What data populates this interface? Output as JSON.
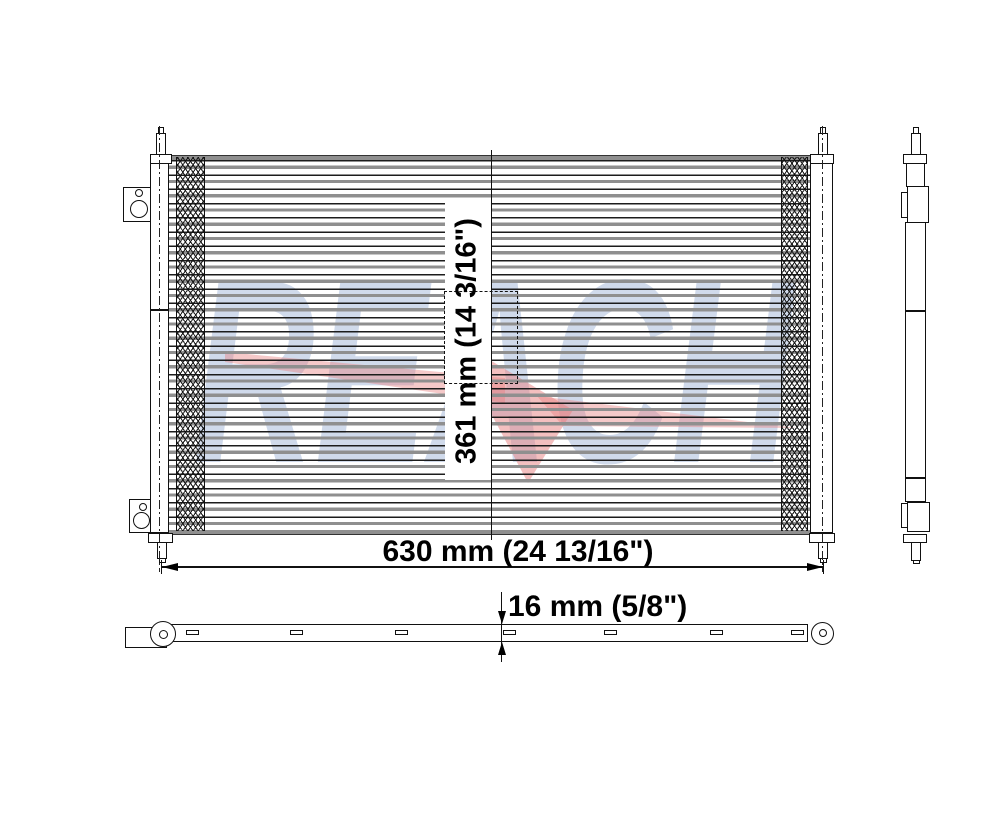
{
  "watermark": {
    "text": "REACH",
    "letter_color": "#ccd7e9",
    "swoosh_color": "#e87f7f"
  },
  "dimensions": {
    "width_label": "630 mm (24 13/16\")",
    "height_label": "361 mm (14 3/16\")",
    "depth_label": "16 mm (5/8\")"
  },
  "line_color": "#111111"
}
